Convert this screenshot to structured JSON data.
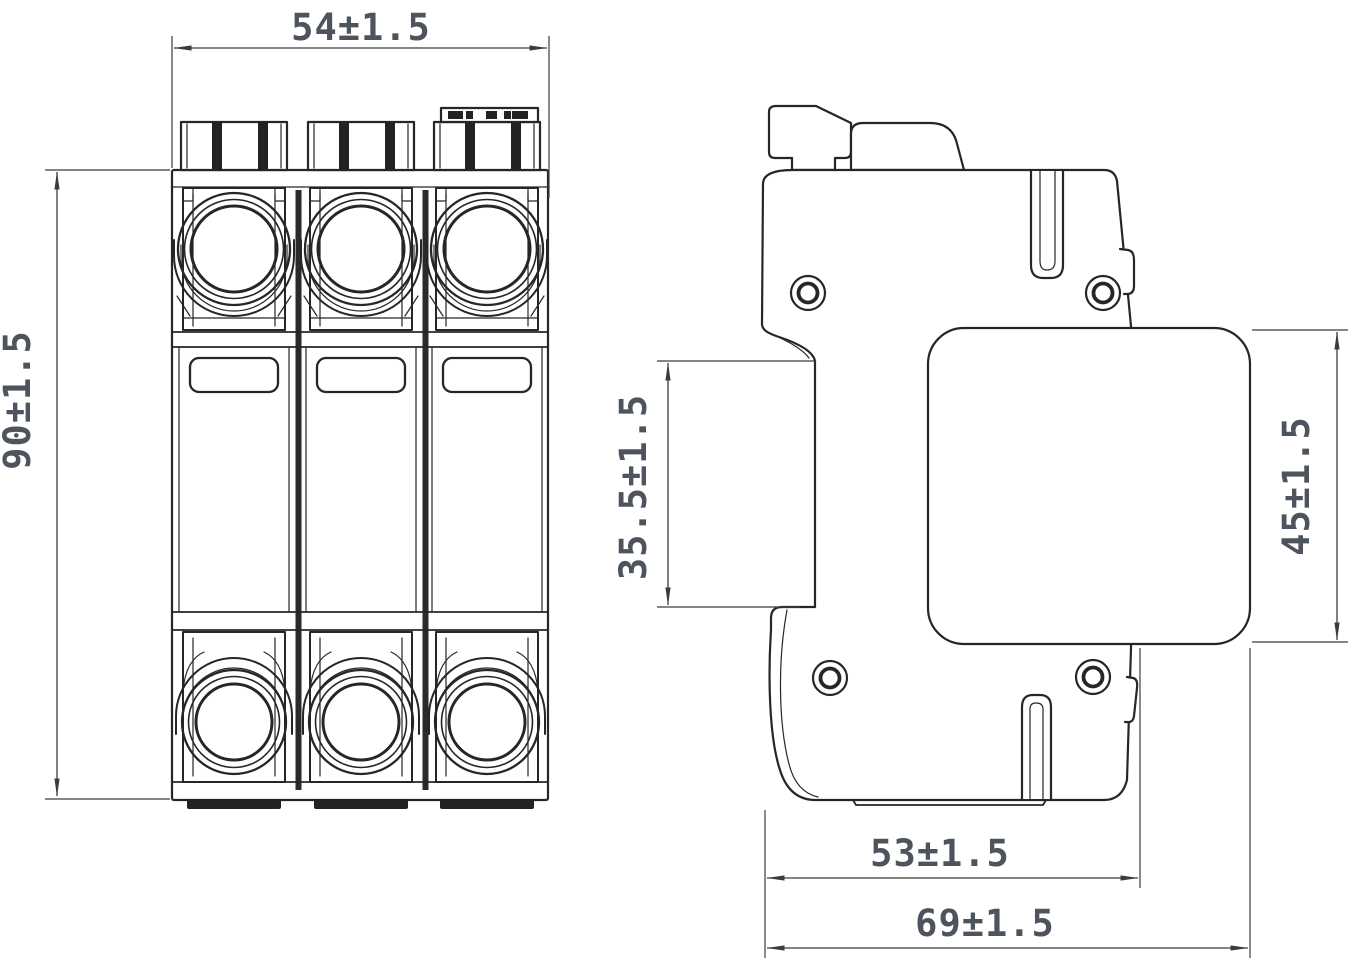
{
  "palette": {
    "line": "#262626",
    "dim_line": "#3c3c3c",
    "dim_text": "#4e545e",
    "dark_fill": "#222222",
    "background": "#ffffff"
  },
  "dimensions": {
    "front_width": "54±1.5",
    "front_height": "90±1.5",
    "side_recess_height": "35.5±1.5",
    "side_module_height": "45±1.5",
    "side_body_depth": "53±1.5",
    "side_total_depth": "69±1.5"
  }
}
